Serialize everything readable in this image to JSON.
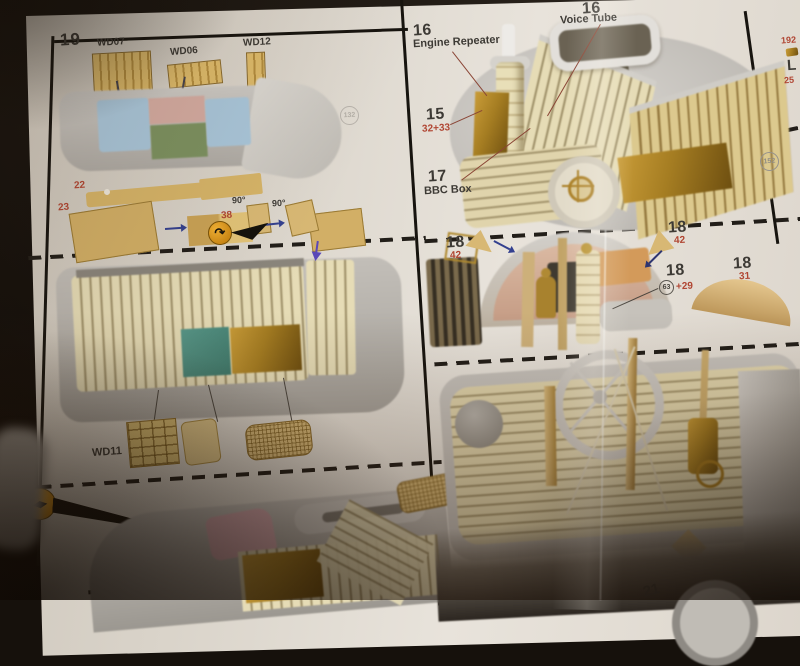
{
  "left_panel": {
    "step": "19",
    "wd07": "WD07",
    "wd06": "WD06",
    "wd12": "WD12",
    "p22": "22",
    "p23": "23",
    "p38": "38",
    "deg1": "90°",
    "deg2": "90°",
    "badge": "132",
    "wd11": "WD11",
    "p38b": "38",
    "p17": "17"
  },
  "right_panel": {
    "er_num": "16",
    "er_label": "Engine Repeater",
    "vt_num": "16",
    "vt_label": "Voice Tube",
    "p15": "15",
    "p15_sub": "32+33",
    "p17": "17",
    "p17_label": "BBC Box",
    "badge": "152",
    "c1_num": "18",
    "c1_sub": "42",
    "c2_num": "18",
    "c2_sub": "42",
    "c3_num": "18",
    "c3_circ": "63",
    "c3_plus": "+29",
    "c4_num": "18",
    "c4_sub": "31"
  },
  "edge_panel": {
    "t1": "192",
    "t2": "L",
    "t3": "25"
  },
  "bottom_strip": {
    "next_step": "21"
  },
  "icons": {
    "bend_tool": "↷",
    "fold_left": "◀",
    "fold_right": "▶"
  },
  "colors": {
    "accent_red": "#b04532",
    "paper": "#e6e1d9",
    "wood": "#ddba6a",
    "deck_blue": "#a9c6da",
    "deck_pink": "#d4aba1",
    "deck_green": "#7c9160",
    "teal_part": "#4c8d7c",
    "brass": "#a57d22",
    "warn_orange": "#e59a12"
  }
}
